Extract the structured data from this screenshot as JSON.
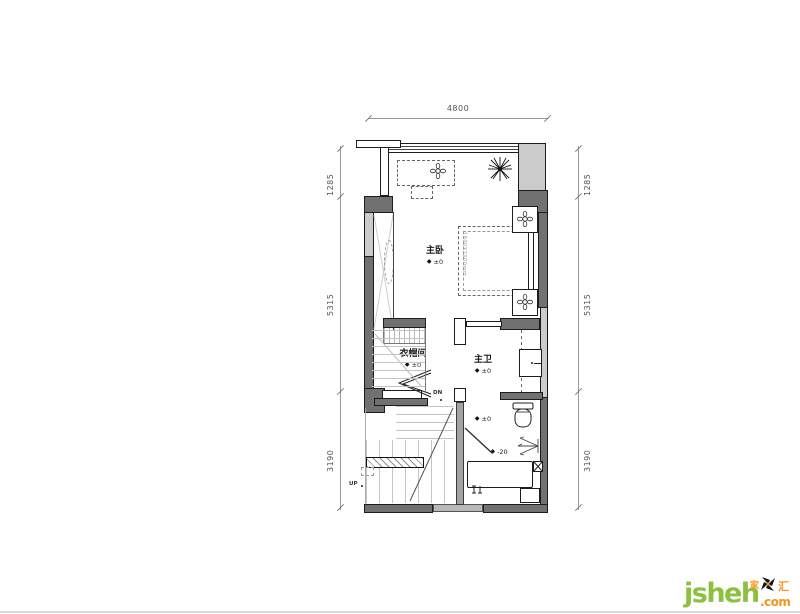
{
  "canvas": {
    "width": 800,
    "height": 614
  },
  "colors": {
    "wall_dark": "#717171",
    "wall_light": "#cbcbcb",
    "wall_mid": "#a3a3a3",
    "line": "#1c1c1c",
    "dim_text": "#555555",
    "tread": "#c4c4c4",
    "brand_green": "#8cc13f",
    "brand_orange": "#f7941d"
  },
  "dimensions": {
    "top": "4800",
    "left": [
      "1285",
      "5315",
      "3190"
    ],
    "right": [
      "1285",
      "5315",
      "3190"
    ]
  },
  "rooms": {
    "master_bedroom": {
      "name": "主卧",
      "elevation": "±0"
    },
    "cloakroom": {
      "name": "衣帽间",
      "elevation": "±0"
    },
    "master_bath": {
      "name": "主卫",
      "elevation": "±0"
    }
  },
  "annotations": {
    "bed_size": "1800X2000mm",
    "shower_elevation_zero": "±0",
    "shower_elevation_minus": "-20",
    "stairs_up": "UP",
    "stairs_down": "DN"
  },
  "icons": {
    "diamond": "◆"
  },
  "watermark": {
    "brand": "jsheh",
    "tld": ".com",
    "logo_text_left": "家",
    "logo_text_right": "汇"
  }
}
